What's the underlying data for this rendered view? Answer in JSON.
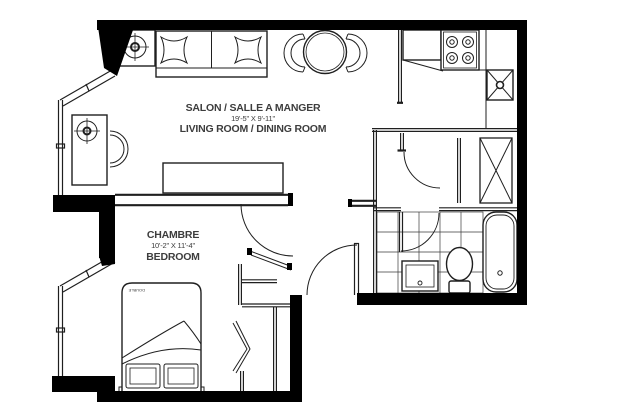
{
  "plan": {
    "living_dining": {
      "title_fr": "SALON / SALLE A MANGER",
      "dimensions": "19'-5\" X 9'-11\"",
      "title_en": "LIVING ROOM  / DINING ROOM"
    },
    "bedroom": {
      "title_fr": "CHAMBRE",
      "dimensions": "10'-2\" X 11'-4\"",
      "title_en": "BEDROOM"
    },
    "bed_label": "DOUBLE"
  },
  "colors": {
    "wall": "#000000",
    "line": "#1f1f1f",
    "text": "#3d3d3d",
    "background": "#ffffff"
  }
}
